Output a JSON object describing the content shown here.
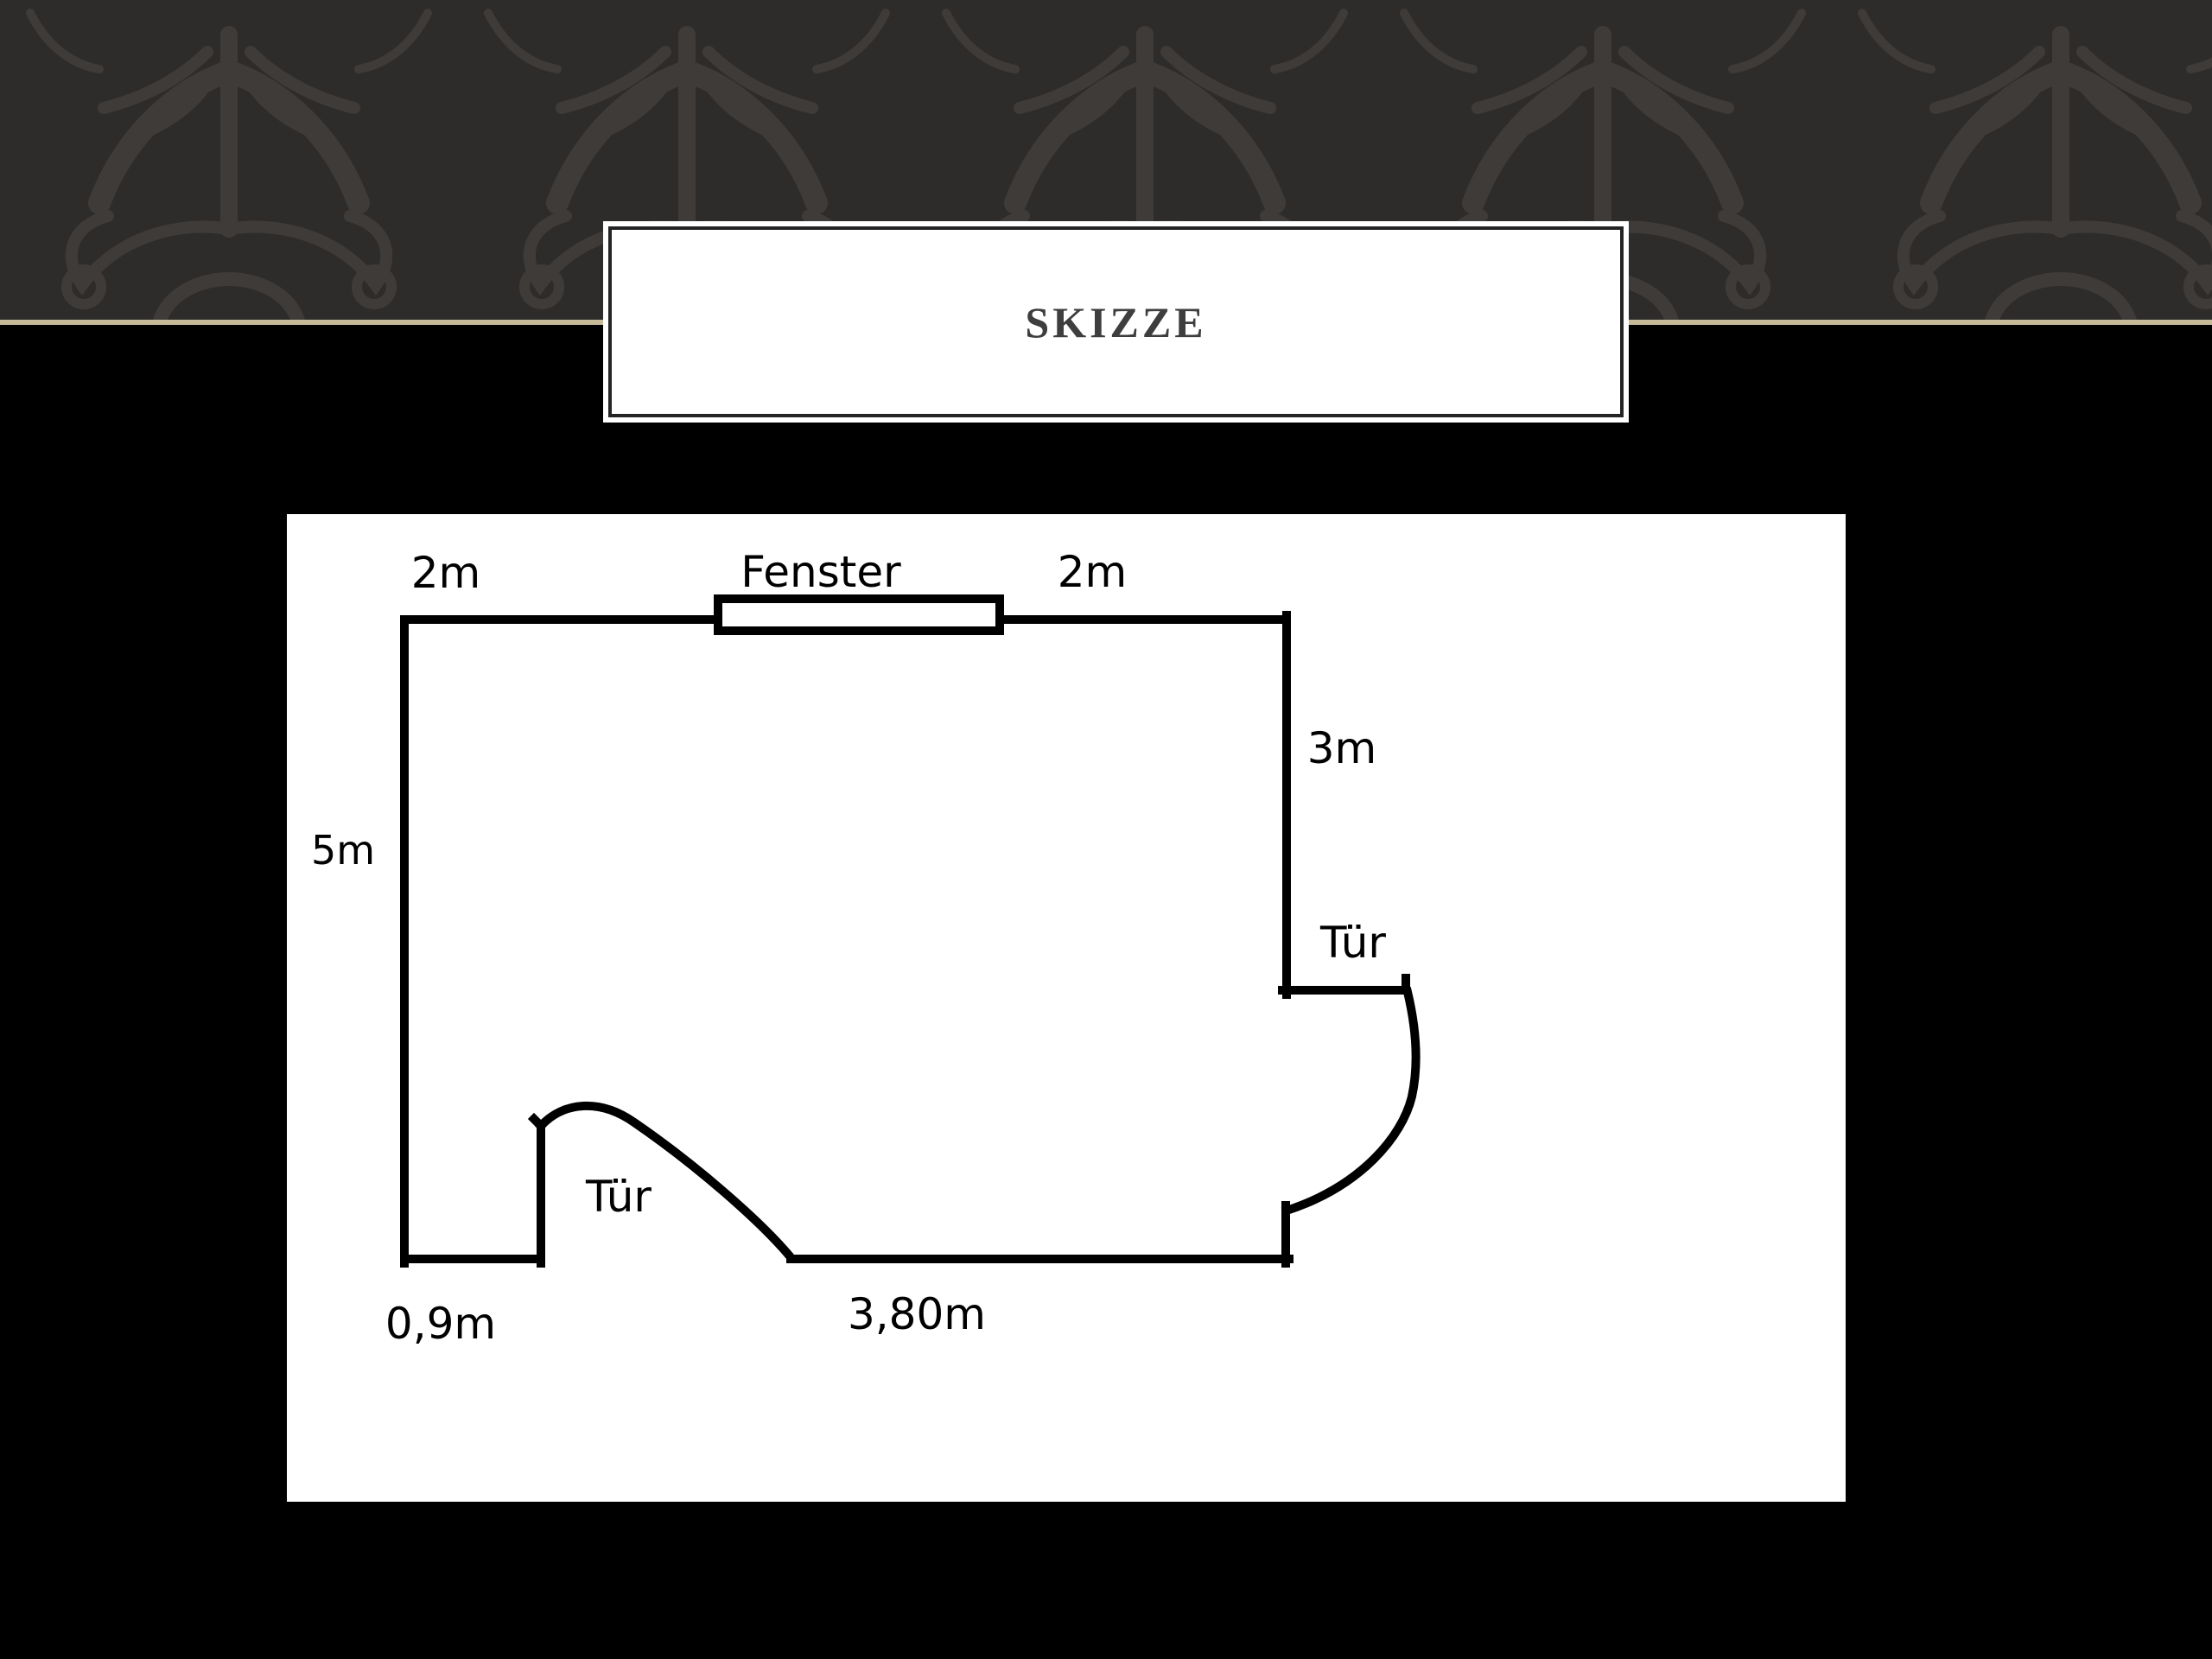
{
  "slide": {
    "title": "SKIZZE",
    "background_color": "#000000",
    "band": {
      "background": "#2e2c2a",
      "pattern_color": "#3e3b39",
      "pattern_name": "damask-flourish",
      "divider_color": "#c7ba99"
    },
    "title_box": {
      "background": "#ffffff",
      "border_color": "#242424",
      "text_color": "#3f3e3e"
    }
  },
  "floor_plan": {
    "background": "#ffffff",
    "line_color": "#000000",
    "labels": {
      "top_left": "2m",
      "window": "Fenster",
      "top_right": "2m",
      "right_wall": "3m",
      "left_wall": "5m",
      "door_right": "Tür",
      "door_left": "Tür",
      "bottom_left": "0,9m",
      "bottom": "3,80m"
    }
  }
}
